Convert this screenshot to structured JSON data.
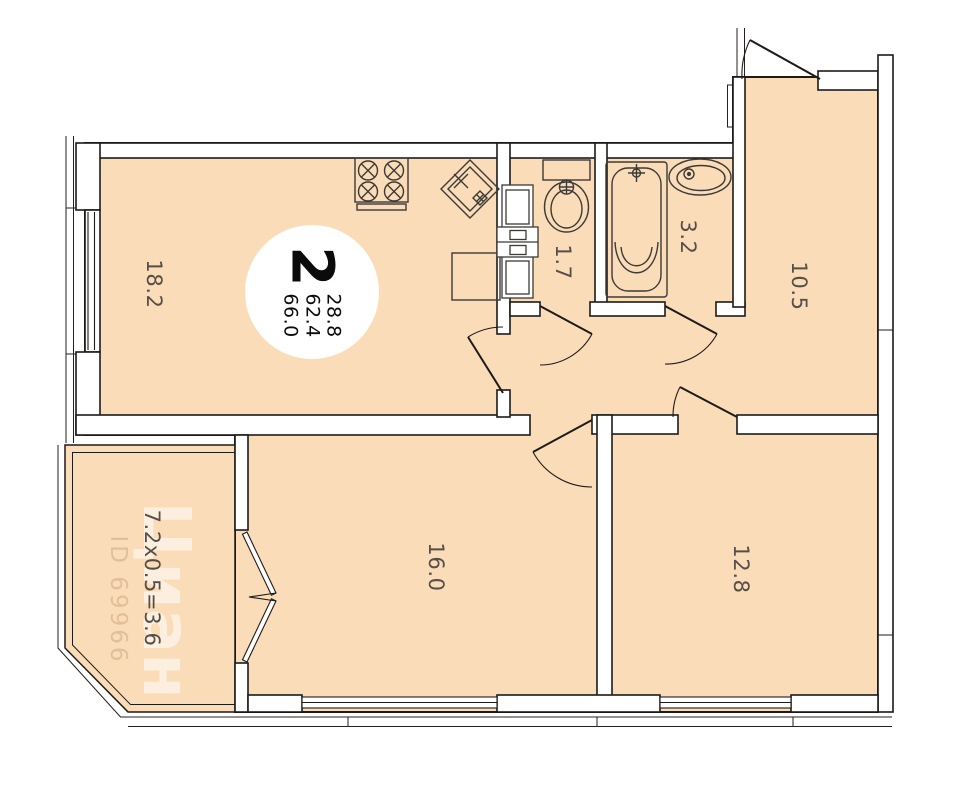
{
  "plan": {
    "watermark": {
      "brand": "Циан",
      "listing_id": "ID 69966"
    },
    "badge": {
      "rooms_count": "2",
      "living_area": "28.8",
      "secondary_area": "62.4",
      "total_area": "66.0"
    },
    "rooms": [
      {
        "name": "living-room",
        "label": "18.2",
        "x": 154,
        "y": 284
      },
      {
        "name": "wc",
        "label": "1.7",
        "x": 563,
        "y": 262
      },
      {
        "name": "bathroom",
        "label": "3.2",
        "x": 688,
        "y": 237
      },
      {
        "name": "bedroom-right",
        "label": "10.5",
        "x": 799,
        "y": 286
      },
      {
        "name": "room-bottom",
        "label": "16.0",
        "x": 436,
        "y": 567
      },
      {
        "name": "bedroom-low",
        "label": "12.8",
        "x": 741,
        "y": 569
      },
      {
        "name": "balcony",
        "label": "7.2x0.5=3.6",
        "x": 152,
        "y": 578
      }
    ],
    "colors": {
      "floor": "#fadcb9",
      "wall_line": "#1d1b18",
      "label": "#554f47",
      "badge_bg": "#ffffff"
    }
  }
}
